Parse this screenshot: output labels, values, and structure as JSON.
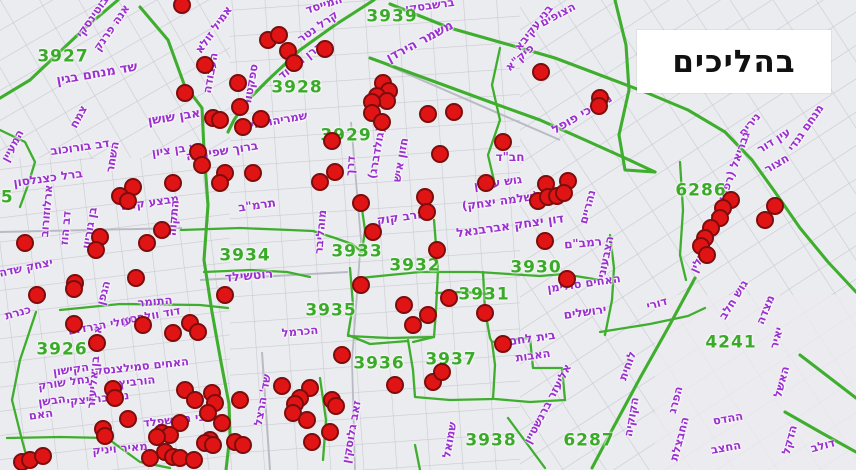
{
  "title_box": {
    "label": "בהליכים"
  },
  "colors": {
    "background": "#ebecef",
    "street_line": "#c9cad1",
    "boundary": "#3fae2e",
    "zone_label": "#3aab28",
    "street_label": "#9b30d0",
    "marker_fill": "#e01414",
    "marker_stroke": "#7d0d0d",
    "title_bg": "#ffffff",
    "title_text": "#111111"
  },
  "map": {
    "zone_labels": [
      {
        "id": "3927",
        "x": 63,
        "y": 57
      },
      {
        "id": "3939",
        "x": 392,
        "y": 17
      },
      {
        "id": "3928",
        "x": 297,
        "y": 88
      },
      {
        "id": "3929",
        "x": 346,
        "y": 136
      },
      {
        "id": "3933",
        "x": 357,
        "y": 252
      },
      {
        "id": "3932",
        "x": 415,
        "y": 266
      },
      {
        "id": "3930",
        "x": 536,
        "y": 268
      },
      {
        "id": "3931",
        "x": 484,
        "y": 295
      },
      {
        "id": "3934",
        "x": 245,
        "y": 256
      },
      {
        "id": "3935",
        "x": 331,
        "y": 311
      },
      {
        "id": "3936",
        "x": 379,
        "y": 364
      },
      {
        "id": "3937",
        "x": 451,
        "y": 360
      },
      {
        "id": "3938",
        "x": 491,
        "y": 441
      },
      {
        "id": "6287",
        "x": 589,
        "y": 441
      },
      {
        "id": "4241",
        "x": 731,
        "y": 343
      },
      {
        "id": "6286",
        "x": 701,
        "y": 191
      },
      {
        "id": "3945",
        "x": -12,
        "y": 198
      },
      {
        "id": "3926",
        "x": 62,
        "y": 350
      }
    ],
    "street_labels": [
      {
        "n": "שד מנחם בגין",
        "x": 97,
        "y": 74,
        "r": -10,
        "s": 13
      },
      {
        "n": "אבן שושן",
        "x": 174,
        "y": 117,
        "r": -9,
        "s": 12.5
      },
      {
        "n": "ש בן ציון",
        "x": 175,
        "y": 150,
        "r": -8
      },
      {
        "n": "ברוך שפינוזה",
        "x": 222,
        "y": 151,
        "r": -9,
        "s": 12
      },
      {
        "n": "דב בורוכוב",
        "x": 80,
        "y": 147,
        "r": -8,
        "s": 12
      },
      {
        "n": "ברל כצנלסון",
        "x": 48,
        "y": 178,
        "r": -8,
        "s": 12
      },
      {
        "n": "ארלוזורוב",
        "x": 47,
        "y": 211,
        "r": -85
      },
      {
        "n": "דב הוז",
        "x": 66,
        "y": 228,
        "r": -85
      },
      {
        "n": "בן גוריון",
        "x": 90,
        "y": 228,
        "r": -80
      },
      {
        "n": "יצחק שדה",
        "x": 26,
        "y": 268,
        "r": -12
      },
      {
        "n": "אמיל זולא",
        "x": 214,
        "y": 30,
        "r": -55
      },
      {
        "n": "אנה פרנק",
        "x": 112,
        "y": 28,
        "r": -55
      },
      {
        "n": "ז'בוטינסקי",
        "x": 95,
        "y": 14,
        "r": -55
      },
      {
        "n": "צמח",
        "x": 79,
        "y": 117,
        "r": -62
      },
      {
        "n": "המעיין",
        "x": 13,
        "y": 146,
        "r": -62
      },
      {
        "n": "השחר",
        "x": 113,
        "y": 157,
        "r": -80
      },
      {
        "n": "העבודה",
        "x": 211,
        "y": 73,
        "r": -80
      },
      {
        "n": "ספקטור",
        "x": 251,
        "y": 85,
        "r": -80
      },
      {
        "n": "שמריהו לוין",
        "x": 277,
        "y": 121,
        "r": -10
      },
      {
        "n": "קרל נטר",
        "x": 318,
        "y": 27,
        "r": -35
      },
      {
        "n": "קרן היסוד",
        "x": 301,
        "y": 61,
        "r": -38
      },
      {
        "n": "המייסד",
        "x": 324,
        "y": 5,
        "r": -18
      },
      {
        "n": "ברשבסקי",
        "x": 430,
        "y": 6,
        "r": -8
      },
      {
        "n": "משמר הירדן",
        "x": 420,
        "y": 42,
        "r": -28,
        "s": 13
      },
      {
        "n": "פיק\"א",
        "x": 520,
        "y": 58,
        "r": -42
      },
      {
        "n": "הצופים",
        "x": 558,
        "y": 15,
        "r": -28
      },
      {
        "n": "בני עקיבא",
        "x": 534,
        "y": 28,
        "r": -52
      },
      {
        "n": "מרדכי פופל",
        "x": 582,
        "y": 114,
        "r": -30,
        "s": 12.5
      },
      {
        "n": "מבצע קדש",
        "x": 150,
        "y": 203,
        "r": -8
      },
      {
        "n": "התקוה",
        "x": 174,
        "y": 218,
        "r": -85
      },
      {
        "n": "תרמ\"ב",
        "x": 257,
        "y": 205,
        "r": -8,
        "s": 12
      },
      {
        "n": "מוהליבר",
        "x": 321,
        "y": 232,
        "r": -85
      },
      {
        "n": "רוטשילד",
        "x": 249,
        "y": 276,
        "r": -5,
        "s": 12.5
      },
      {
        "n": "התומר",
        "x": 155,
        "y": 302,
        "r": -5
      },
      {
        "n": "דוד וולפסון",
        "x": 151,
        "y": 316,
        "r": -10
      },
      {
        "n": "הגפן",
        "x": 104,
        "y": 293,
        "r": -75
      },
      {
        "n": "הרב קוק",
        "x": 401,
        "y": 217,
        "r": -8,
        "s": 12
      },
      {
        "n": "דרך",
        "x": 351,
        "y": 166,
        "r": -85
      },
      {
        "n": "(גולדברג)",
        "x": 377,
        "y": 153,
        "r": -80
      },
      {
        "n": "חזון איש",
        "x": 401,
        "y": 160,
        "r": -80
      },
      {
        "n": "חב\"ד",
        "x": 510,
        "y": 157,
        "r": 0,
        "s": 12
      },
      {
        "n": "גוש עציון",
        "x": 498,
        "y": 183,
        "r": -8
      },
      {
        "n": "(שלמה יצחק)",
        "x": 500,
        "y": 201,
        "r": -8,
        "s": 12
      },
      {
        "n": "דון יצחק אברבנאל",
        "x": 510,
        "y": 226,
        "r": -8,
        "s": 12.5
      },
      {
        "n": "רמב\"ם",
        "x": 583,
        "y": 243,
        "r": -5,
        "s": 12
      },
      {
        "n": "נהריים",
        "x": 588,
        "y": 207,
        "r": -75
      },
      {
        "n": "הצבעוני",
        "x": 606,
        "y": 257,
        "r": -78
      },
      {
        "n": "האחים סולימן",
        "x": 584,
        "y": 284,
        "r": -8
      },
      {
        "n": "ירושלים",
        "x": 585,
        "y": 312,
        "r": -8,
        "s": 12
      },
      {
        "n": "בית לחם",
        "x": 532,
        "y": 338,
        "r": -8,
        "s": 12
      },
      {
        "n": "האבות",
        "x": 533,
        "y": 356,
        "r": -8
      },
      {
        "n": "אליעזר ברנשטיין",
        "x": 548,
        "y": 404,
        "r": -62
      },
      {
        "n": "לוחית",
        "x": 628,
        "y": 366,
        "r": -70
      },
      {
        "n": "הקוקיה",
        "x": 632,
        "y": 417,
        "r": -80
      },
      {
        "n": "דורי",
        "x": 657,
        "y": 304,
        "r": -15
      },
      {
        "n": "שד' הרצל",
        "x": 263,
        "y": 400,
        "r": -80
      },
      {
        "n": "זאב גלוסקין",
        "x": 352,
        "y": 432,
        "r": -80
      },
      {
        "n": "שמואל",
        "x": 450,
        "y": 440,
        "r": -80
      },
      {
        "n": "כנרת",
        "x": 18,
        "y": 313,
        "r": -15
      },
      {
        "n": "הקישון",
        "x": 71,
        "y": 370,
        "r": -8
      },
      {
        "n": "נחל שורק",
        "x": 64,
        "y": 383,
        "r": -8
      },
      {
        "n": "הבשן",
        "x": 52,
        "y": 401,
        "r": -8
      },
      {
        "n": "האם",
        "x": 41,
        "y": 415,
        "r": -8
      },
      {
        "n": "עולי הגרדום",
        "x": 100,
        "y": 326,
        "r": -10
      },
      {
        "n": "האחים סמילצנסקי",
        "x": 140,
        "y": 367,
        "r": -6
      },
      {
        "n": "הורביץ",
        "x": 137,
        "y": 382,
        "r": -6
      },
      {
        "n": "נתן ברניצקי",
        "x": 98,
        "y": 399,
        "r": -6
      },
      {
        "n": "צבי הירשפלד",
        "x": 178,
        "y": 420,
        "r": -6
      },
      {
        "n": "מאיר ויניק",
        "x": 120,
        "y": 449,
        "r": -5
      },
      {
        "n": "אריה בן אליעזר",
        "x": 95,
        "y": 367,
        "r": -85
      },
      {
        "n": "נירים",
        "x": 750,
        "y": 125,
        "r": -50
      },
      {
        "n": "עין דור",
        "x": 774,
        "y": 141,
        "r": -32
      },
      {
        "n": "חצור",
        "x": 777,
        "y": 164,
        "r": -30
      },
      {
        "n": "מנחם גנדי",
        "x": 806,
        "y": 128,
        "r": -55
      },
      {
        "n": "גבריאל (רפפורט)",
        "x": 731,
        "y": 176,
        "r": -70
      },
      {
        "n": "אביעזר ילין",
        "x": 706,
        "y": 245,
        "r": -65
      },
      {
        "n": "גוש חלב",
        "x": 734,
        "y": 300,
        "r": -58
      },
      {
        "n": "מצדה",
        "x": 766,
        "y": 310,
        "r": -68
      },
      {
        "n": "יאיר",
        "x": 777,
        "y": 338,
        "r": -75
      },
      {
        "n": "האשל",
        "x": 782,
        "y": 382,
        "r": -75
      },
      {
        "n": "ההדס",
        "x": 728,
        "y": 419,
        "r": -10
      },
      {
        "n": "החצב",
        "x": 726,
        "y": 448,
        "r": -10
      },
      {
        "n": "הפרג",
        "x": 676,
        "y": 400,
        "r": -75
      },
      {
        "n": "החבצלת",
        "x": 680,
        "y": 439,
        "r": -75
      },
      {
        "n": "הדקל",
        "x": 790,
        "y": 440,
        "r": -75
      },
      {
        "n": "דולב",
        "x": 823,
        "y": 446,
        "r": -15
      },
      {
        "n": "הכרמל",
        "x": 300,
        "y": 332,
        "r": -5
      }
    ],
    "markers": [
      [
        182,
        5
      ],
      [
        205,
        65
      ],
      [
        240,
        107
      ],
      [
        238,
        83
      ],
      [
        185,
        93
      ],
      [
        213,
        118
      ],
      [
        220,
        120
      ],
      [
        243,
        127
      ],
      [
        261,
        119
      ],
      [
        268,
        40
      ],
      [
        279,
        35
      ],
      [
        288,
        51
      ],
      [
        294,
        63
      ],
      [
        325,
        49
      ],
      [
        198,
        152
      ],
      [
        202,
        165
      ],
      [
        225,
        173
      ],
      [
        220,
        183
      ],
      [
        253,
        173
      ],
      [
        173,
        183
      ],
      [
        133,
        187
      ],
      [
        120,
        196
      ],
      [
        128,
        201
      ],
      [
        162,
        230
      ],
      [
        147,
        243
      ],
      [
        100,
        237
      ],
      [
        96,
        250
      ],
      [
        25,
        243
      ],
      [
        75,
        283
      ],
      [
        74,
        289
      ],
      [
        37,
        295
      ],
      [
        136,
        278
      ],
      [
        225,
        295
      ],
      [
        383,
        83
      ],
      [
        389,
        91
      ],
      [
        377,
        96
      ],
      [
        387,
        101
      ],
      [
        372,
        102
      ],
      [
        372,
        113
      ],
      [
        382,
        122
      ],
      [
        332,
        141
      ],
      [
        335,
        172
      ],
      [
        320,
        182
      ],
      [
        428,
        114
      ],
      [
        454,
        112
      ],
      [
        503,
        142
      ],
      [
        440,
        154
      ],
      [
        361,
        203
      ],
      [
        373,
        232
      ],
      [
        425,
        197
      ],
      [
        427,
        212
      ],
      [
        541,
        72
      ],
      [
        600,
        98
      ],
      [
        599,
        106
      ],
      [
        486,
        183
      ],
      [
        546,
        184
      ],
      [
        568,
        181
      ],
      [
        538,
        201
      ],
      [
        548,
        197
      ],
      [
        557,
        196
      ],
      [
        564,
        193
      ],
      [
        545,
        241
      ],
      [
        567,
        279
      ],
      [
        437,
        250
      ],
      [
        361,
        285
      ],
      [
        404,
        305
      ],
      [
        449,
        298
      ],
      [
        428,
        315
      ],
      [
        413,
        325
      ],
      [
        485,
        313
      ],
      [
        503,
        344
      ],
      [
        342,
        355
      ],
      [
        731,
        200
      ],
      [
        723,
        208
      ],
      [
        720,
        218
      ],
      [
        711,
        228
      ],
      [
        705,
        238
      ],
      [
        701,
        246
      ],
      [
        707,
        255
      ],
      [
        775,
        206
      ],
      [
        765,
        220
      ],
      [
        74,
        324
      ],
      [
        97,
        343
      ],
      [
        143,
        325
      ],
      [
        173,
        333
      ],
      [
        190,
        323
      ],
      [
        198,
        332
      ],
      [
        113,
        389
      ],
      [
        115,
        398
      ],
      [
        103,
        429
      ],
      [
        105,
        436
      ],
      [
        128,
        419
      ],
      [
        22,
        462
      ],
      [
        30,
        460
      ],
      [
        43,
        456
      ],
      [
        185,
        390
      ],
      [
        195,
        400
      ],
      [
        212,
        393
      ],
      [
        215,
        403
      ],
      [
        208,
        413
      ],
      [
        240,
        400
      ],
      [
        222,
        423
      ],
      [
        180,
        423
      ],
      [
        162,
        433
      ],
      [
        170,
        435
      ],
      [
        157,
        437
      ],
      [
        210,
        440
      ],
      [
        205,
        443
      ],
      [
        213,
        445
      ],
      [
        235,
        442
      ],
      [
        243,
        445
      ],
      [
        150,
        458
      ],
      [
        165,
        452
      ],
      [
        173,
        457
      ],
      [
        180,
        458
      ],
      [
        194,
        460
      ],
      [
        282,
        386
      ],
      [
        310,
        388
      ],
      [
        300,
        398
      ],
      [
        295,
        404
      ],
      [
        293,
        413
      ],
      [
        307,
        420
      ],
      [
        332,
        400
      ],
      [
        336,
        406
      ],
      [
        330,
        432
      ],
      [
        312,
        442
      ],
      [
        395,
        385
      ],
      [
        433,
        382
      ],
      [
        442,
        372
      ]
    ]
  }
}
